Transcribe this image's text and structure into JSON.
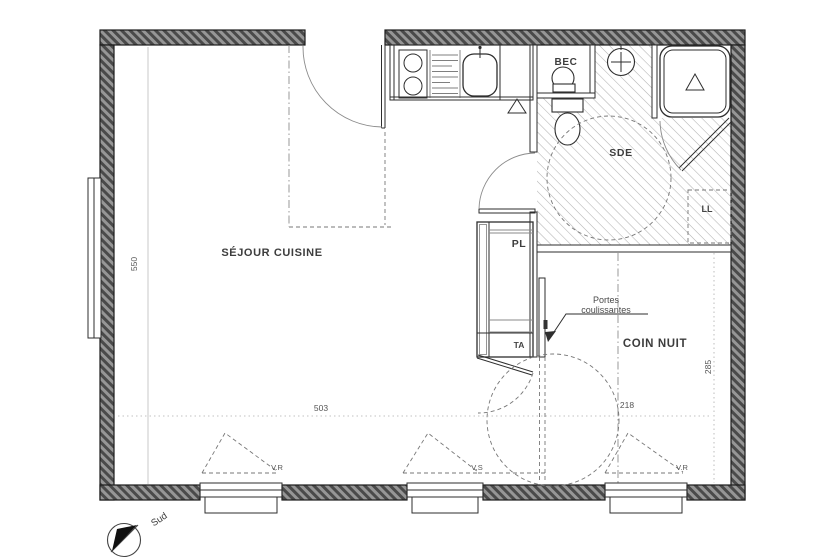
{
  "plan": {
    "rooms": {
      "sejour": "SÉJOUR CUISINE",
      "sde": "SDE",
      "coin_nuit": "COIN NUIT",
      "pl": "PL",
      "bec": "BEC",
      "ll": "LL",
      "ta": "TA"
    },
    "annotations": {
      "sliding_doors_line1": "Portes",
      "sliding_doors_line2": "coulissantes"
    },
    "dimensions": {
      "left_height": "550",
      "sejour_width": "503",
      "coin_nuit_width": "218",
      "coin_nuit_height": "285"
    },
    "windows": {
      "w1": "V.R",
      "w2": "V.S",
      "w3": "V.R"
    },
    "compass": {
      "south": "Sud"
    },
    "colors": {
      "wall_fill": "#969696",
      "wall_stripe": "#4a4a4a",
      "ink": "#2e2e2e",
      "floor_hatch": "#b3b3b3"
    }
  }
}
